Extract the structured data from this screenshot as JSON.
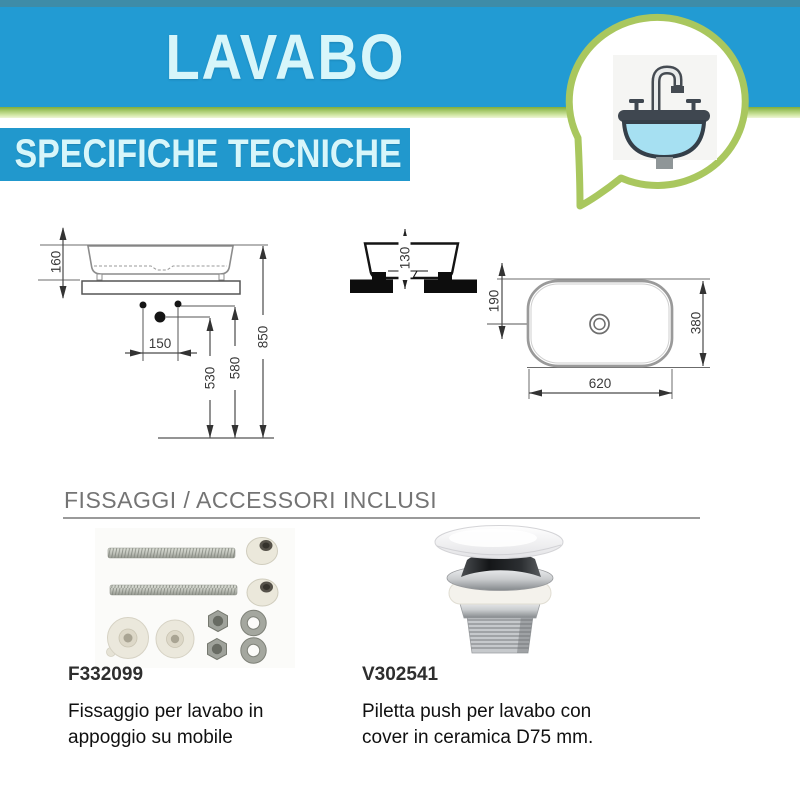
{
  "header": {
    "title": "LAVABO",
    "subtitle": "SPECIFICHE TECNICHE",
    "icon": "sink-icon",
    "colors": {
      "top_strip": "#3e8ca8",
      "banner_blue": "#229bd3",
      "accent_green": "#a9c75e",
      "title_text": "#d7f6fa"
    }
  },
  "drawings": {
    "dims": {
      "h160": "160",
      "w150": "150",
      "h530": "530",
      "h580": "580",
      "h850": "850",
      "h130": "130",
      "o190": "190",
      "d380": "380",
      "w620": "620"
    }
  },
  "accessories": {
    "section_title": "FISSAGGI / ACCESSORI INCLUSI",
    "items": [
      {
        "code": "F332099",
        "description": "Fissaggio per lavabo in appoggio su mobile",
        "image": "fixing-kit"
      },
      {
        "code": "V302541",
        "description": "Piletta push per lavabo con cover in ceramica D75 mm.",
        "image": "push-drain"
      }
    ]
  }
}
